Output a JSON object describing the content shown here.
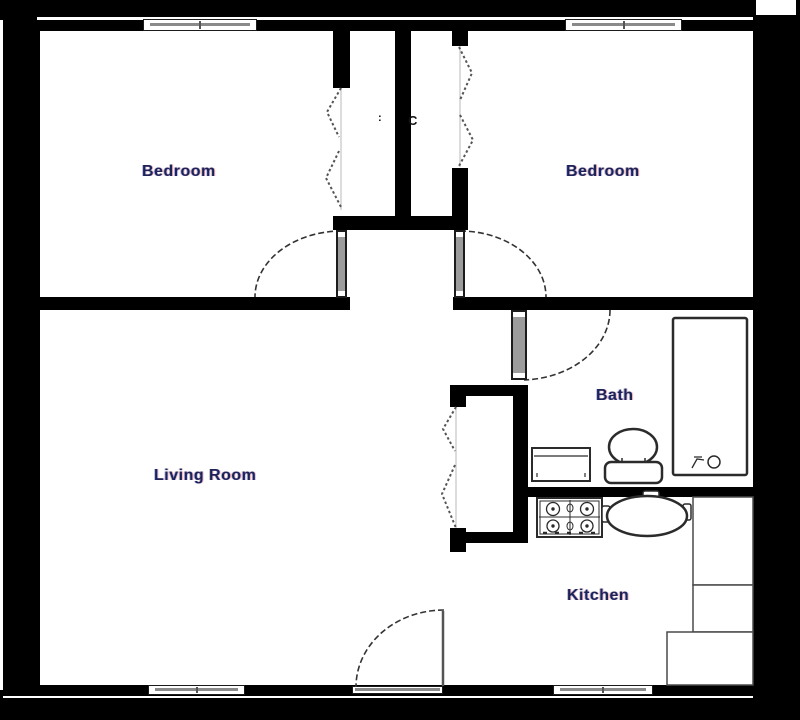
{
  "labels": {
    "bedroom_left": "Bedroom",
    "bedroom_right": "Bedroom",
    "living_room": "Living Room",
    "bath": "Bath",
    "kitchen": "Kitchen",
    "closet_right": "C",
    "closet_left_mark": ":"
  },
  "colors": {
    "wall": "#000000",
    "door_leaf": "#9c9c9c",
    "window_glass": "#8a8a8a",
    "label_text": "#1e2357",
    "fixture_stroke": "#2b2b2b"
  },
  "fixtures": {
    "tub": "bathtub",
    "toilet": "toilet",
    "sink": "vanity-sink",
    "stove": "cooktop-stove",
    "table": "dining-table",
    "counters": "kitchen-counter"
  }
}
